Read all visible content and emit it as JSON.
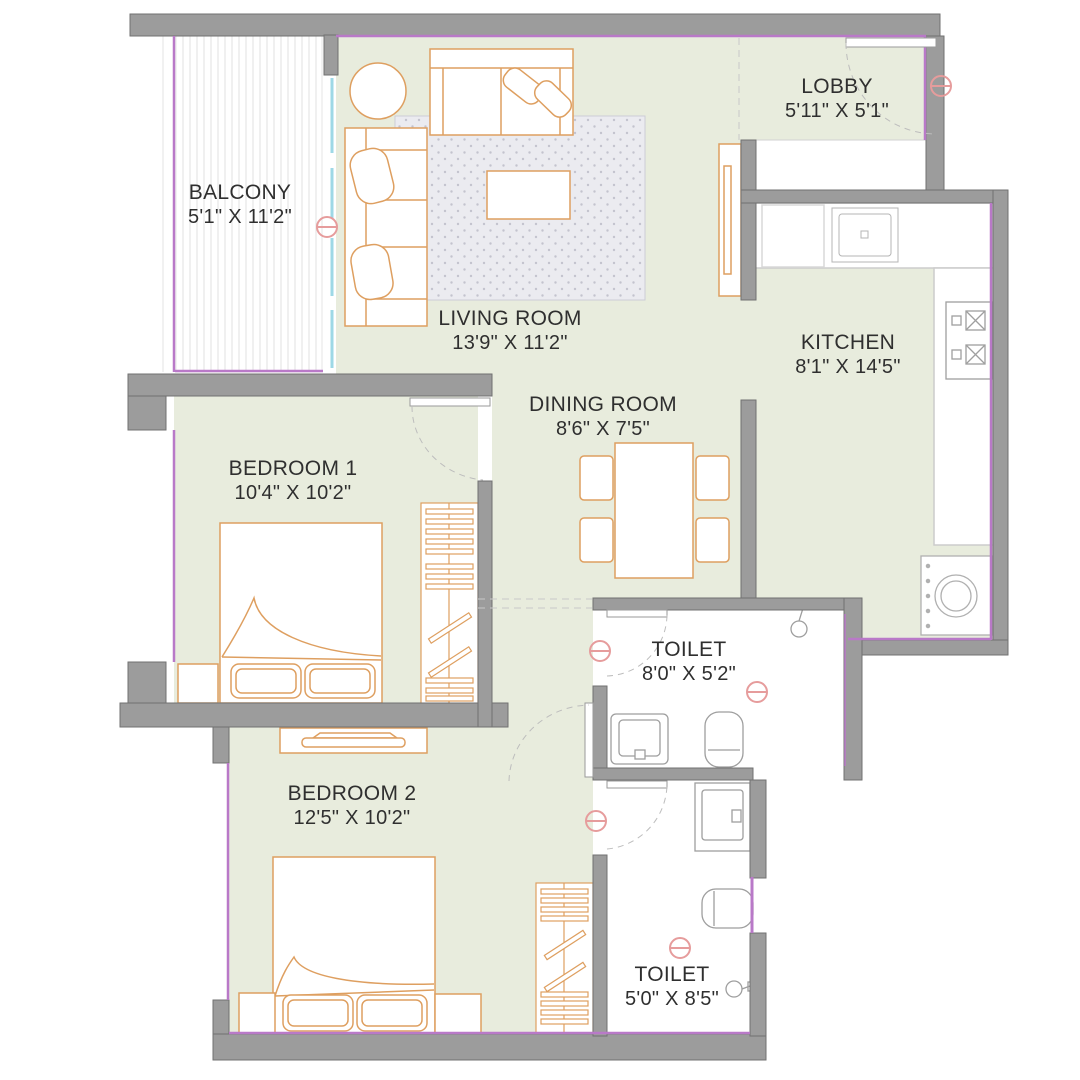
{
  "floor_plan": {
    "type": "apartment-2bhk-floor-plan",
    "rooms": [
      {
        "id": "balcony",
        "name": "BALCONY",
        "dims": "5'1\" X 11'2\""
      },
      {
        "id": "living",
        "name": "LIVING ROOM",
        "dims": "13'9\" X 11'2\""
      },
      {
        "id": "lobby",
        "name": "LOBBY",
        "dims": "5'11\" X 5'1\""
      },
      {
        "id": "kitchen",
        "name": "KITCHEN",
        "dims": "8'1\" X 14'5\""
      },
      {
        "id": "dining",
        "name": "DINING ROOM",
        "dims": "8'6\" X 7'5\""
      },
      {
        "id": "bedroom1",
        "name": "BEDROOM 1",
        "dims": "10'4\" X 10'2\""
      },
      {
        "id": "bedroom2",
        "name": "BEDROOM 2",
        "dims": "12'5\" X 10'2\""
      },
      {
        "id": "toilet1",
        "name": "TOILET",
        "dims": "8'0\" X 5'2\""
      },
      {
        "id": "toilet2",
        "name": "TOILET",
        "dims": "5'0\" X 8'5\""
      }
    ],
    "furniture": {
      "living": [
        "round-table",
        "two-seat-sofa",
        "three-seat-sofa",
        "rug",
        "coffee-table",
        "tv-unit"
      ],
      "kitchen": [
        "counter",
        "fridge",
        "sink",
        "stove",
        "washing-machine"
      ],
      "dining": [
        "dining-table",
        "chairs-x4"
      ],
      "bedroom1": [
        "double-bed",
        "side-table",
        "wardrobe"
      ],
      "bedroom2": [
        "double-bed",
        "side-tables",
        "wardrobe",
        "dresser"
      ],
      "toilet1": [
        "washbasin",
        "wc",
        "shower"
      ],
      "toilet2": [
        "washbasin",
        "wc",
        "shower"
      ]
    },
    "colors": {
      "floor": "#e8ecdd",
      "wall_fill": "#9c9c9c",
      "wall_edge": "#717171",
      "furniture_outline": "#de9f60",
      "fixture_outline": "#a6a6a6",
      "window_line": "#b979c8",
      "slider_line": "#9ed8e6",
      "marker": "#e69c9c",
      "text": "#2f2f2f"
    }
  }
}
